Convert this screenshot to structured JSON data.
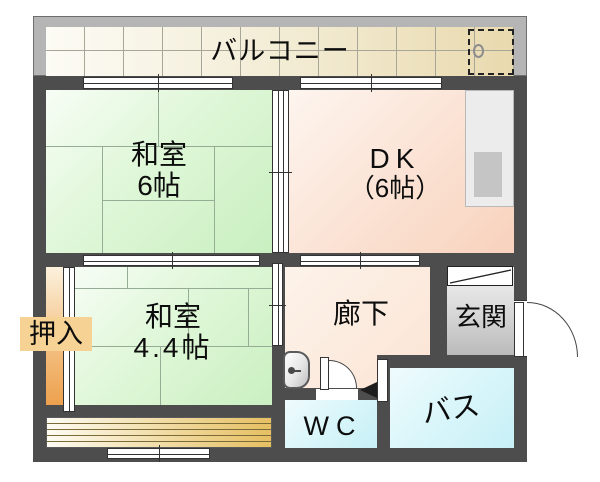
{
  "plan": {
    "balcony": {
      "label": "バルコニー"
    },
    "rooms": {
      "washitsu6": {
        "name": "和室",
        "size": "6帖"
      },
      "dk": {
        "name": "DK",
        "size": "（6帖）"
      },
      "washitsu44": {
        "name": "和室",
        "size": "4.4帖"
      },
      "oshiire": {
        "label": "押入"
      },
      "rouka": {
        "label": "廊下"
      },
      "genkan": {
        "label": "玄関"
      },
      "wc": {
        "label": "WC"
      },
      "bath": {
        "label": "バス"
      }
    },
    "colors": {
      "wall": "#4d4d4d",
      "balcony_frame": "#b5b5b5",
      "balcony_tile": "#e9d9ae",
      "tatami_green": "#c9efc0",
      "dk_pink": "#f8d2bd",
      "corridor_peach": "#fbe4d4",
      "water_cyan": "#c7f0f7",
      "genkan_gray": "#b9b9b9",
      "closet_orange": "#eda14e",
      "engawa_tan": "#e6bf62"
    }
  }
}
